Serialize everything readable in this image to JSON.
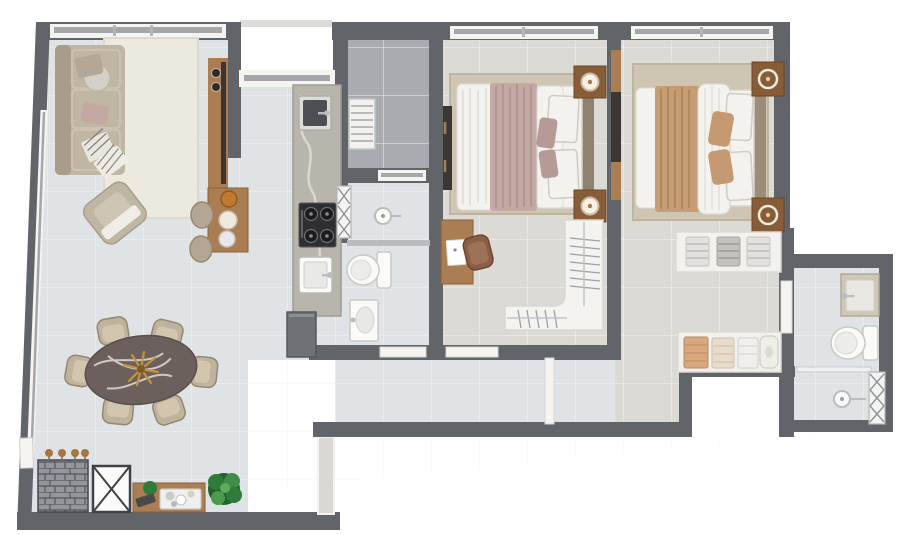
{
  "palette": {
    "outside": "#ffffff",
    "wall": "#616469",
    "wall_trim": "#dcdcd9",
    "frame": "#f5f4f1",
    "glass": "#a3a6aa",
    "tile": "#e0e3e6",
    "grout": "#f2f4f6",
    "floor_bed": "#dbdad5",
    "floor_service": "#a8abaf",
    "rug_cream": "#ece9de",
    "rug_beige": "#cec6b3",
    "wood": "#aa7d52",
    "wood_dark": "#875c39",
    "sofa": "#c0b6a4",
    "sofa_dark": "#a89d88",
    "bed_white": "#f3f2ee",
    "mauve": "#c3a8a4",
    "tan": "#c79d74",
    "marble": "#b8b5ac",
    "marble_vein": "#dedbd2",
    "dark": "#2f2f33",
    "stone": "#6c605d",
    "stone_vein": "#e9e4dc",
    "chair": "#bfb39d",
    "plant": "#2f7c3a",
    "plant_dark": "#215f2b",
    "brick": "#93969a",
    "brick_joint": "#53565b",
    "metal": "#b9bcc0",
    "fixture": "#fafaf8",
    "fixture_line": "#c9c9c4",
    "gold": "#c3933f"
  },
  "plan": {
    "type": "apartment-floor-plan-3d-top-view",
    "rooms": [
      {
        "name": "living-room",
        "furniture": [
          "l-shaped-sofa",
          "round-cushion",
          "striped-throws",
          "armchair",
          "cream-area-rug",
          "media-panel",
          "bar-counter",
          "bar-stools-x2",
          "bowls-and-plates"
        ]
      },
      {
        "name": "dining-area",
        "furniture": [
          "oval-stone-table",
          "gold-centerpiece",
          "dining-chairs-x6"
        ]
      },
      {
        "name": "terrace-strip",
        "furniture": [
          "brick-barbecue",
          "planters-x4",
          "service-shaft",
          "wood-sideboard",
          "serving-tray",
          "potted-plant"
        ]
      },
      {
        "name": "kitchen",
        "furniture": [
          "marble-counter-run",
          "prep-sink",
          "cooktop-4-burner",
          "main-sink",
          "refrigerator"
        ]
      },
      {
        "name": "service-area",
        "furniture": [
          "drying-rack",
          "wall-ladder"
        ]
      },
      {
        "name": "bathroom-1",
        "furniture": [
          "shower-head",
          "glass-partition",
          "toilet",
          "washbasin"
        ]
      },
      {
        "name": "bedroom-1",
        "furniture": [
          "double-bed",
          "mauve-throw",
          "nightstands-x2",
          "table-lamps-x2",
          "beige-rug",
          "wall-wardrobe",
          "desk",
          "desk-chair",
          "l-shaped-closet-with-hangers"
        ]
      },
      {
        "name": "bedroom-2-master",
        "furniture": [
          "double-bed",
          "tan-throw",
          "nightstands-x2",
          "ring-lamps-x2",
          "beige-rug",
          "wall-wardrobe"
        ]
      },
      {
        "name": "master-closet-corridor",
        "furniture": [
          "open-shelf-upper-3-stacks",
          "open-shelf-lower-4-items"
        ]
      },
      {
        "name": "master-bathroom",
        "furniture": [
          "vanity-washbasin",
          "toilet",
          "glass-partition",
          "walk-in-shower",
          "towel-ladder"
        ]
      },
      {
        "name": "hallway",
        "furniture": []
      }
    ],
    "openings": [
      "entry-door-left-wall",
      "bathroom-1-door",
      "bedroom-1-door",
      "master-suite-door",
      "master-bathroom-door"
    ],
    "windows": [
      "living-top-window",
      "living-side-window-slanted",
      "kitchen-window",
      "service-window",
      "bedroom-1-window",
      "bedroom-2-window"
    ]
  }
}
